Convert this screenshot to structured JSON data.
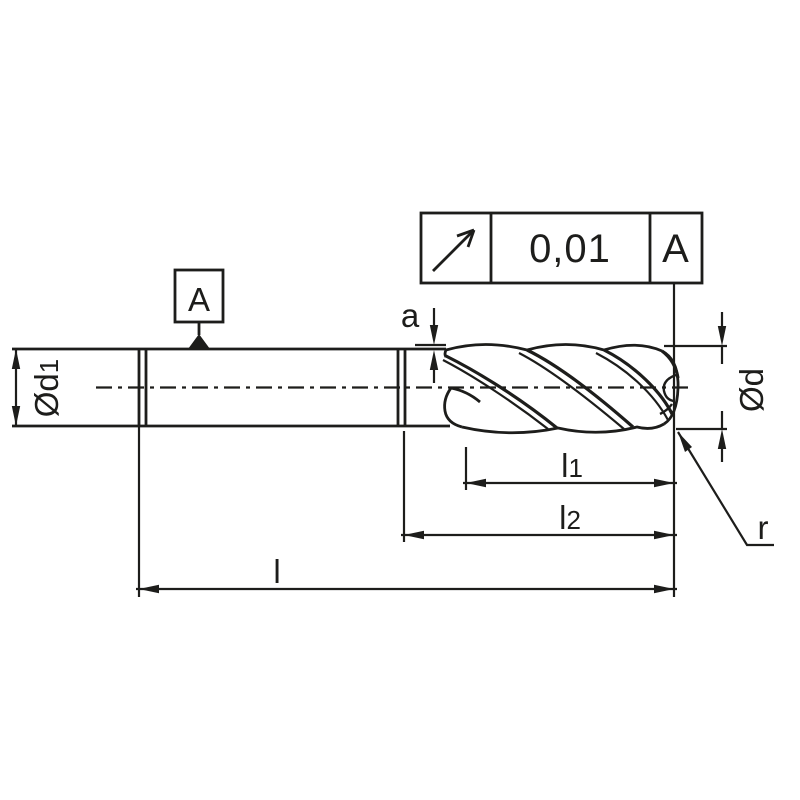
{
  "title": "End mill technical drawing",
  "ink_color": "#1d1d1b",
  "tolerance_frame": {
    "symbol": "runout-arrow",
    "tolerance": "0,01",
    "datum_ref": "A"
  },
  "datum_flag": {
    "label": "A"
  },
  "dimensions": {
    "d1": {
      "base": "Ød",
      "sub": "1"
    },
    "d": {
      "base": "Ød"
    },
    "a": {
      "label": "a"
    },
    "l1": {
      "base": "l",
      "sub": "1"
    },
    "l2": {
      "base": "l",
      "sub": "2"
    },
    "l": {
      "label": "l"
    },
    "r": {
      "label": "r"
    }
  }
}
